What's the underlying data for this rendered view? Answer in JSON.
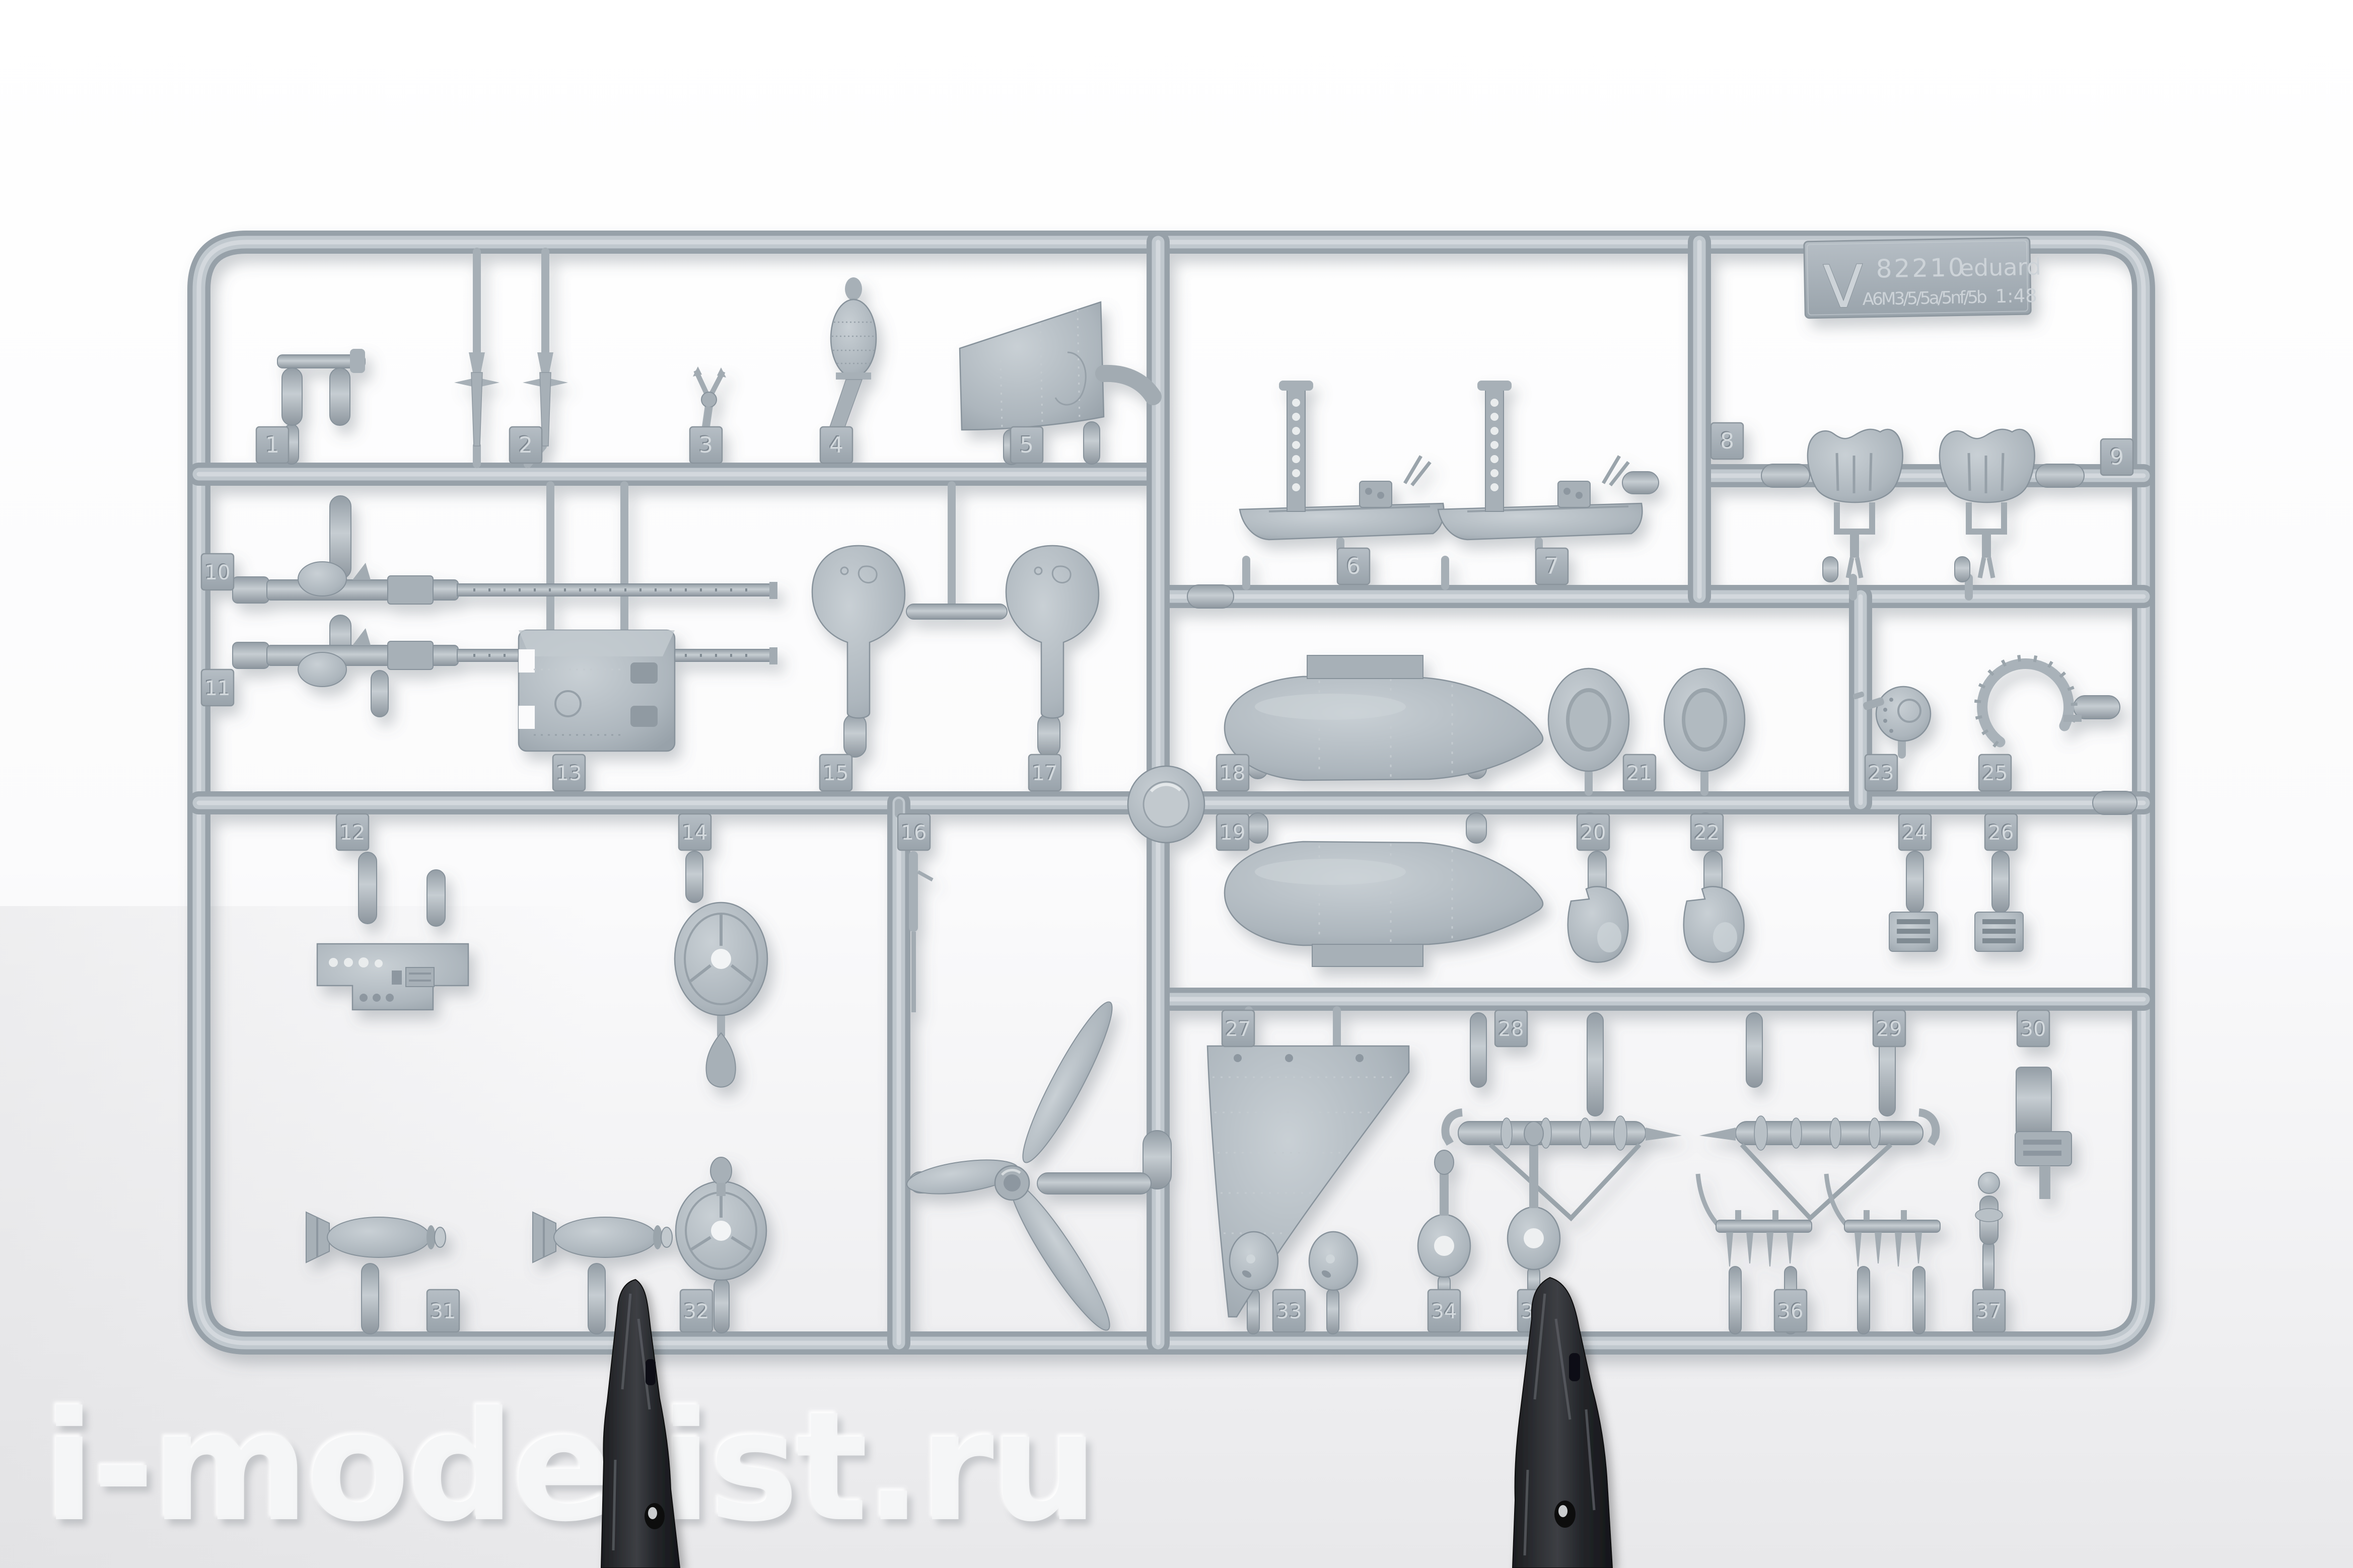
{
  "watermark": {
    "text": "i-modelist.ru"
  },
  "label": {
    "sprue_letter": "V",
    "kit_number": "82210",
    "brand": "eduard",
    "variant": "A6M3/5/5a/5nf/5b",
    "scale": "1:48"
  },
  "part_numbers": [
    "1",
    "2",
    "3",
    "4",
    "5",
    "6",
    "7",
    "8",
    "9",
    "10",
    "11",
    "12",
    "13",
    "14",
    "15",
    "16",
    "17",
    "18",
    "19",
    "20",
    "21",
    "22",
    "23",
    "24",
    "25",
    "26",
    "27",
    "28",
    "29",
    "30",
    "31",
    "32",
    "33",
    "34",
    "35",
    "36",
    "37"
  ],
  "colors": {
    "plastic_base": "#adb6bd",
    "plastic_light": "#c9d0d5",
    "plastic_dark": "#87929b",
    "runner_core": "#d9dee1",
    "tag_numeral": "#d3d9dd",
    "clip_dark": "#26272b",
    "background_top": "#ffffff",
    "background_bottom": "#e8e8ea"
  }
}
